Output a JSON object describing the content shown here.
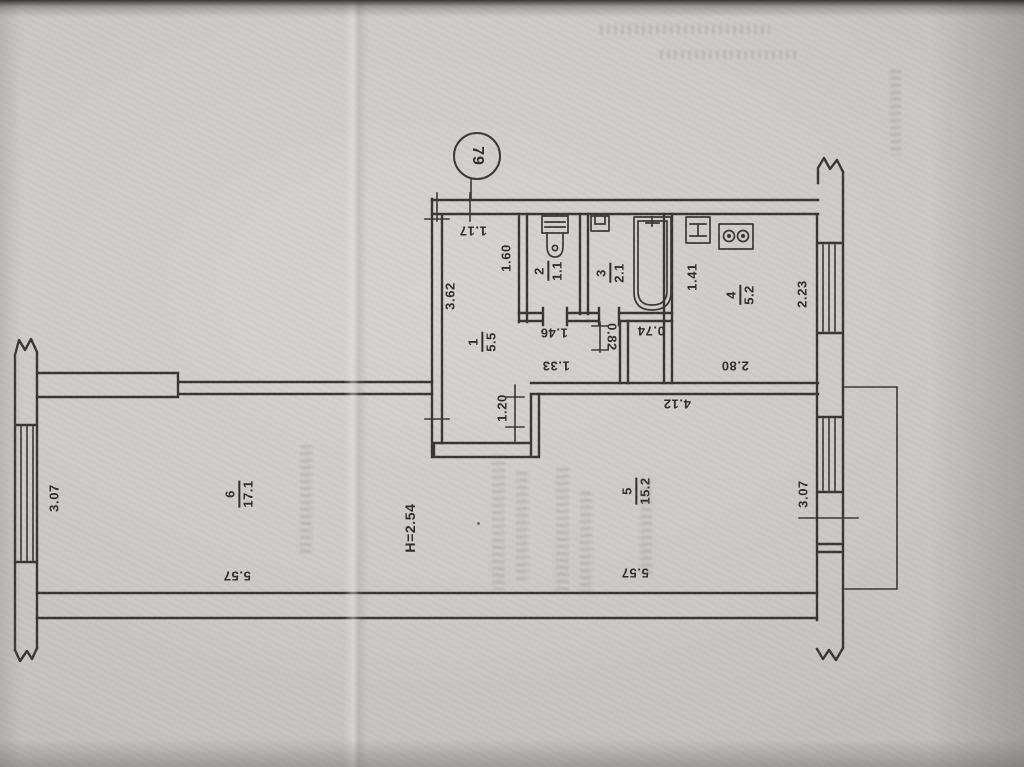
{
  "plan": {
    "apartment_number": "79",
    "ceiling_height": "H=2.54",
    "rooms": [
      {
        "number": "1",
        "area": "5.5"
      },
      {
        "number": "2",
        "area": "1.1"
      },
      {
        "number": "3",
        "area": "2.1"
      },
      {
        "number": "4",
        "area": "5.2"
      },
      {
        "number": "5",
        "area": "15.2"
      },
      {
        "number": "6",
        "area": "17.1"
      }
    ],
    "dimensions": {
      "entrance_door": "1.17",
      "hall_length": "3.62",
      "hall_width": "1.60",
      "wc_width": "1.46",
      "lobby_width": "1.33",
      "lobby_depth": "0.82",
      "bath_passage": "0.74",
      "kitchen_left": "1.41",
      "kitchen_window": "2.23",
      "kitchen_width": "2.80",
      "room5_top_width": "4.12",
      "room5_door": "1.20",
      "room5_bottom_width": "5.57",
      "room5_window": "3.07",
      "room6_bottom_width": "5.57",
      "room6_window": "3.07"
    },
    "colors": {
      "ink": "#383532",
      "paper": "#cac8c5"
    }
  }
}
